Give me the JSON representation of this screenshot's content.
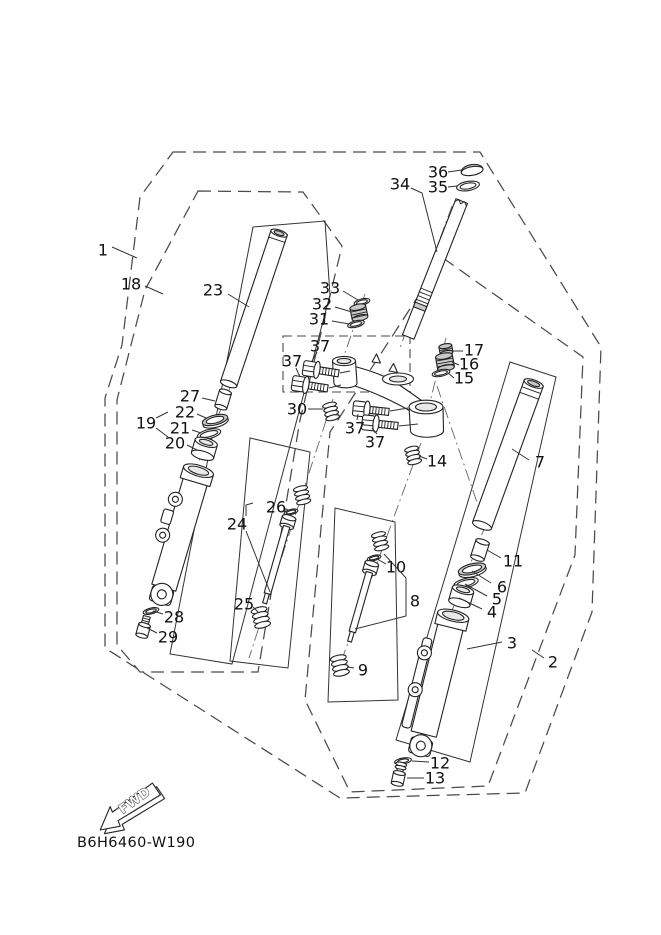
{
  "diagram": {
    "code": "B6H6460-W190",
    "fwd_label": "FWD",
    "line_color": "#222222",
    "boundary_color": "#4a4a4a",
    "background": "#ffffff"
  },
  "callouts": [
    {
      "text": "1",
      "x": 103,
      "y": 250,
      "leaders": [
        [
          [
            112,
            247
          ],
          [
            137,
            258
          ]
        ]
      ]
    },
    {
      "text": "18",
      "x": 131,
      "y": 284,
      "leaders": [
        [
          [
            145,
            286
          ],
          [
            163,
            294
          ]
        ]
      ]
    },
    {
      "text": "23",
      "x": 213,
      "y": 290,
      "leaders": [
        [
          [
            228,
            294
          ],
          [
            249,
            307
          ]
        ]
      ]
    },
    {
      "text": "33",
      "x": 330,
      "y": 288,
      "leaders": [
        [
          [
            343,
            291
          ],
          [
            358,
            300
          ]
        ]
      ]
    },
    {
      "text": "32",
      "x": 322,
      "y": 304,
      "leaders": [
        [
          [
            335,
            307
          ],
          [
            352,
            312
          ]
        ]
      ]
    },
    {
      "text": "31",
      "x": 319,
      "y": 319,
      "leaders": [
        [
          [
            332,
            321
          ],
          [
            349,
            324
          ]
        ]
      ]
    },
    {
      "text": "34",
      "x": 400,
      "y": 184,
      "leaders": [
        [
          [
            411,
            188
          ],
          [
            422,
            193
          ],
          [
            437,
            252
          ]
        ]
      ]
    },
    {
      "text": "36",
      "x": 438,
      "y": 172,
      "leaders": [
        [
          [
            448,
            172
          ],
          [
            462,
            170
          ]
        ]
      ]
    },
    {
      "text": "35",
      "x": 438,
      "y": 187,
      "leaders": [
        [
          [
            448,
            187
          ],
          [
            457,
            186
          ]
        ]
      ]
    },
    {
      "text": "17",
      "x": 474,
      "y": 350,
      "leaders": [
        [
          [
            463,
            351
          ],
          [
            453,
            351
          ]
        ]
      ]
    },
    {
      "text": "16",
      "x": 469,
      "y": 364,
      "leaders": [
        [
          [
            459,
            365
          ],
          [
            452,
            362
          ]
        ]
      ]
    },
    {
      "text": "15",
      "x": 464,
      "y": 378,
      "leaders": [
        [
          [
            454,
            378
          ],
          [
            448,
            373
          ]
        ]
      ]
    },
    {
      "text": "37",
      "x": 320,
      "y": 346,
      "leaders": [
        [
          [
            317,
            352
          ],
          [
            312,
            361
          ]
        ]
      ]
    },
    {
      "text": "37",
      "x": 292,
      "y": 361,
      "leaders": [
        [
          [
            296,
            368
          ],
          [
            300,
            377
          ]
        ]
      ]
    },
    {
      "text": "30",
      "x": 297,
      "y": 409,
      "leaders": [
        [
          [
            308,
            409
          ],
          [
            323,
            409
          ]
        ]
      ]
    },
    {
      "text": "37",
      "x": 355,
      "y": 428,
      "leaders": [
        [
          [
            357,
            420
          ],
          [
            358,
            414
          ]
        ]
      ]
    },
    {
      "text": "37",
      "x": 375,
      "y": 442,
      "leaders": [
        [
          [
            377,
            434
          ],
          [
            372,
            428
          ]
        ]
      ]
    },
    {
      "text": "14",
      "x": 437,
      "y": 461,
      "leaders": [
        [
          [
            427,
            459
          ],
          [
            419,
            456
          ]
        ]
      ]
    },
    {
      "text": "7",
      "x": 540,
      "y": 462,
      "leaders": [
        [
          [
            529,
            460
          ],
          [
            512,
            449
          ]
        ]
      ]
    },
    {
      "text": "27",
      "x": 190,
      "y": 396,
      "leaders": [
        [
          [
            202,
            398
          ],
          [
            215,
            401
          ]
        ]
      ]
    },
    {
      "text": "22",
      "x": 185,
      "y": 412,
      "leaders": [
        [
          [
            197,
            414
          ],
          [
            206,
            418
          ]
        ]
      ]
    },
    {
      "text": "21",
      "x": 180,
      "y": 428,
      "leaders": [
        [
          [
            192,
            430
          ],
          [
            201,
            433
          ]
        ]
      ]
    },
    {
      "text": "20",
      "x": 175,
      "y": 443,
      "leaders": [
        [
          [
            187,
            445
          ],
          [
            197,
            450
          ]
        ]
      ]
    },
    {
      "text": "19",
      "x": 146,
      "y": 423,
      "leaders": [
        [
          [
            156,
            418
          ],
          [
            168,
            412
          ]
        ],
        [
          [
            156,
            428
          ],
          [
            168,
            437
          ]
        ]
      ]
    },
    {
      "text": "24",
      "x": 237,
      "y": 524,
      "leaders": [
        [
          [
            246,
            516
          ],
          [
            246,
            505
          ],
          [
            253,
            503
          ]
        ],
        [
          [
            246,
            531
          ],
          [
            270,
            592
          ]
        ]
      ]
    },
    {
      "text": "26",
      "x": 276,
      "y": 507,
      "leaders": [
        [
          [
            286,
            509
          ],
          [
            290,
            511
          ]
        ]
      ]
    },
    {
      "text": "25",
      "x": 244,
      "y": 604,
      "leaders": [
        [
          [
            253,
            607
          ],
          [
            259,
            613
          ]
        ]
      ]
    },
    {
      "text": "28",
      "x": 174,
      "y": 617,
      "leaders": [
        [
          [
            163,
            614
          ],
          [
            153,
            611
          ]
        ]
      ]
    },
    {
      "text": "29",
      "x": 168,
      "y": 637,
      "leaders": [
        [
          [
            157,
            633
          ],
          [
            147,
            628
          ]
        ]
      ]
    },
    {
      "text": "10",
      "x": 396,
      "y": 567,
      "leaders": [
        [
          [
            386,
            564
          ],
          [
            377,
            559
          ]
        ]
      ]
    },
    {
      "text": "8",
      "x": 415,
      "y": 601,
      "leaders": [
        [
          [
            406,
            578
          ],
          [
            406,
            616
          ]
        ],
        [
          [
            406,
            578
          ],
          [
            384,
            554
          ]
        ],
        [
          [
            406,
            616
          ],
          [
            355,
            629
          ]
        ]
      ]
    },
    {
      "text": "9",
      "x": 363,
      "y": 670,
      "leaders": [
        [
          [
            354,
            668
          ],
          [
            347,
            667
          ]
        ]
      ]
    },
    {
      "text": "11",
      "x": 513,
      "y": 561,
      "leaders": [
        [
          [
            501,
            558
          ],
          [
            487,
            550
          ]
        ]
      ]
    },
    {
      "text": "6",
      "x": 502,
      "y": 587,
      "leaders": [
        [
          [
            491,
            583
          ],
          [
            472,
            571
          ]
        ]
      ]
    },
    {
      "text": "5",
      "x": 497,
      "y": 599,
      "leaders": [
        [
          [
            487,
            596
          ],
          [
            465,
            584
          ]
        ]
      ]
    },
    {
      "text": "4",
      "x": 492,
      "y": 612,
      "leaders": [
        [
          [
            482,
            609
          ],
          [
            459,
            598
          ]
        ]
      ]
    },
    {
      "text": "3",
      "x": 512,
      "y": 643,
      "leaders": [
        [
          [
            502,
            642
          ],
          [
            467,
            649
          ]
        ]
      ]
    },
    {
      "text": "2",
      "x": 553,
      "y": 662,
      "leaders": [
        [
          [
            544,
            658
          ],
          [
            532,
            650
          ]
        ]
      ]
    },
    {
      "text": "12",
      "x": 440,
      "y": 763,
      "leaders": [
        [
          [
            429,
            762
          ],
          [
            412,
            761
          ]
        ]
      ]
    },
    {
      "text": "13",
      "x": 435,
      "y": 778,
      "leaders": [
        [
          [
            424,
            778
          ],
          [
            407,
            778
          ]
        ]
      ]
    }
  ]
}
